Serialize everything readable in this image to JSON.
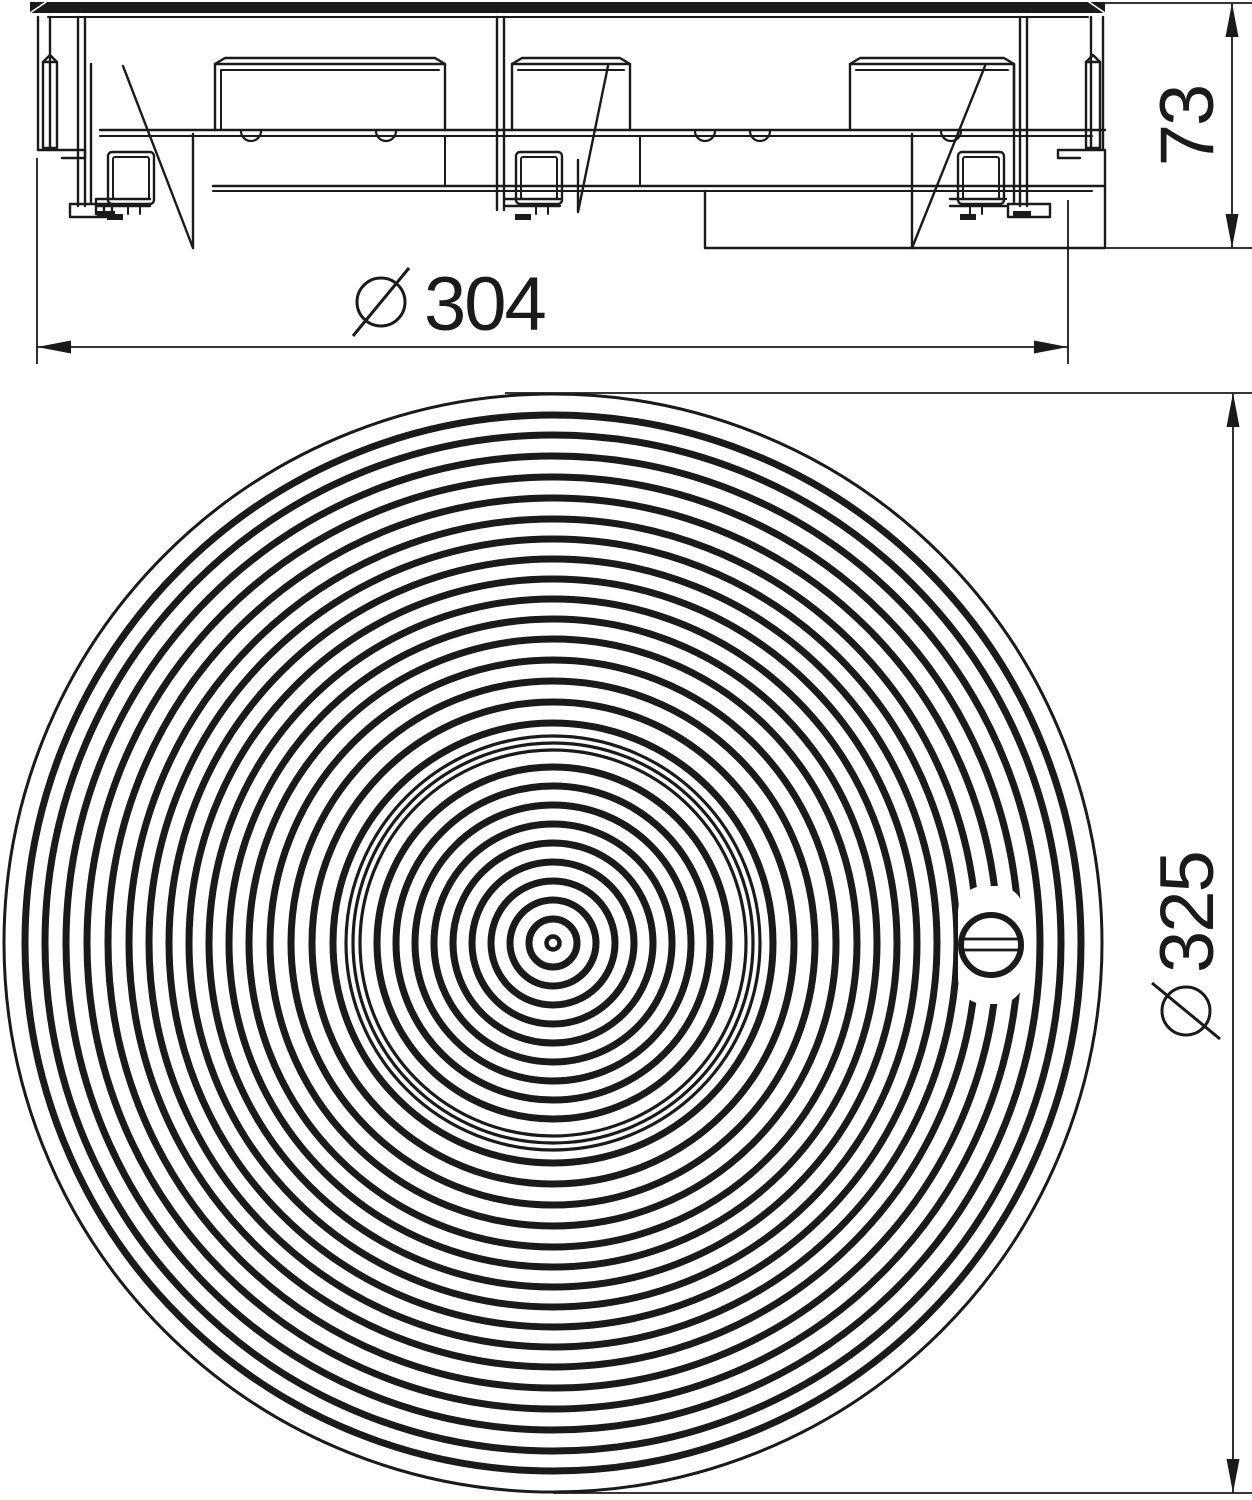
{
  "drawing": {
    "type": "technical-drawing-floor-box-cover",
    "views": {
      "side_view_name": "side-section-view",
      "top_view_name": "plan-view-cover"
    }
  },
  "dims": {
    "height": {
      "label": "73",
      "diameter_symbol": false,
      "orientation": "vertical"
    },
    "flange": {
      "label": "304",
      "diameter_symbol": true,
      "orientation": "horizontal"
    },
    "cover": {
      "label": "325",
      "diameter_symbol": true,
      "orientation": "vertical"
    }
  },
  "top_view": {
    "center": {
      "x": 553,
      "y": 943
    },
    "outer_edge_radius": 549,
    "outer_rings": [
      220,
      241,
      262,
      283,
      304,
      324,
      344,
      364,
      384,
      404,
      424,
      445,
      466,
      487,
      508,
      528
    ],
    "rim_rings": [
      193,
      200,
      207
    ],
    "inner_rings": [
      24,
      43,
      62,
      81,
      100,
      119,
      138,
      157,
      176
    ],
    "center_hole_radius": 6.5,
    "screw": {
      "x": 991,
      "y": 945,
      "head_radius": 30,
      "slot_y1": 939,
      "slot_y2": 950,
      "slot_x1": 962,
      "slot_x2": 1020
    }
  },
  "colors": {
    "line": "#1a1a1a",
    "background": "#ffffff"
  }
}
